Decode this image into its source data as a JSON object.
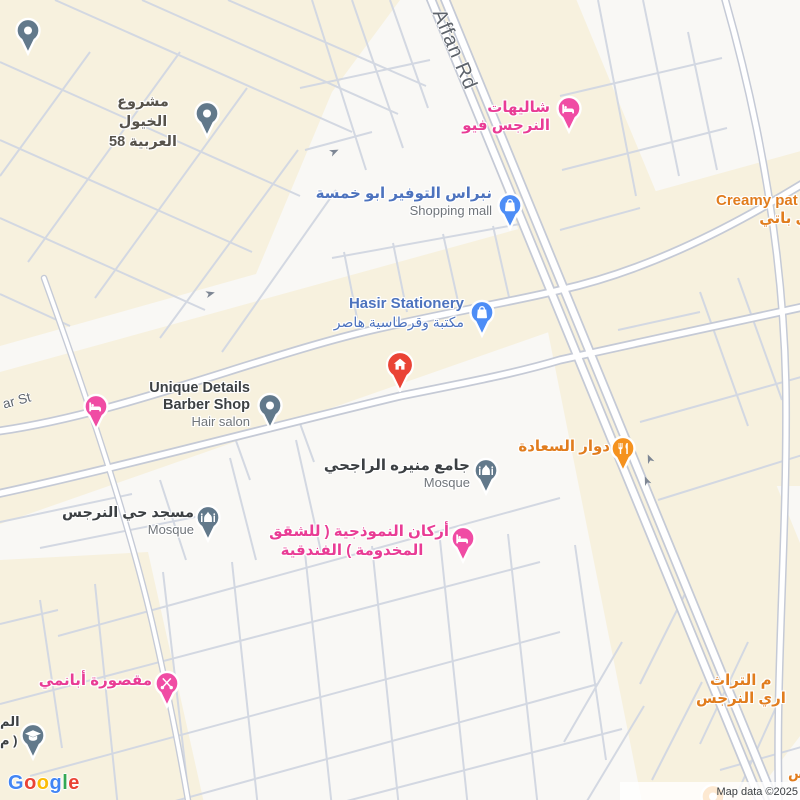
{
  "colors": {
    "shopping_pin": "#4D8DF6",
    "shopping_text": "#4D73BE",
    "hotel_pin": "#F04CA4",
    "hotel_text": "#E93C95",
    "food_pin": "#F5921E",
    "food_text": "#E17D1E",
    "generic_pin": "#62798B",
    "generic_text": "#3C4043",
    "area_text": "#57534C",
    "secondary_text": "#70757A",
    "street_text": "#5E646C",
    "marker_red": "#EA4335",
    "road_casing": "#C5CAD6",
    "road_fill": "#FFFFFF",
    "minor_road": "#D3D8E2",
    "block_cream": "#F7F1DE",
    "block_white": "#F9F8F5"
  },
  "streets": {
    "affan": "Affan Rd",
    "ar_st": "ar St"
  },
  "pois": {
    "horses": {
      "line1": "مشروع الخيول",
      "line2": "العربية 58"
    },
    "chalets": {
      "name": "شاليهات النرجس فيو"
    },
    "nebras": {
      "name": "نبراس التوفير ابو خمسة",
      "sub": "Shopping mall"
    },
    "creamy": {
      "name": "Creamy pat",
      "sub": "مي باتي"
    },
    "hasir": {
      "name": "Hasir Stationery",
      "sub": "مكتبة وقرطاسية هاصر"
    },
    "barber": {
      "line1": "Unique Details",
      "line2": "Barber Shop",
      "sub": "Hair salon"
    },
    "rajhi": {
      "name": "جامع منيره الراجحي",
      "sub": "Mosque"
    },
    "saada": {
      "name": "دوار السعادة"
    },
    "narjis_mosque": {
      "name": "مسجد حي النرجس",
      "sub": "Mosque"
    },
    "arkan": {
      "line1": "أركان النموذجية ( للشقق",
      "line2": "المخدومة ) الفندقية"
    },
    "maqsura": {
      "name": "مقصورة أبانمي"
    },
    "heritage": {
      "line1": "م التراث",
      "line2": "اري النرجس"
    },
    "edge_left": {
      "line1": "الم",
      "line2": "( م"
    },
    "edge_right": {
      "partial": "س"
    }
  },
  "logo_letters": [
    {
      "ch": "G",
      "color": "#4285F4"
    },
    {
      "ch": "o",
      "color": "#EA4335"
    },
    {
      "ch": "o",
      "color": "#FBBC05"
    },
    {
      "ch": "g",
      "color": "#4285F4"
    },
    {
      "ch": "l",
      "color": "#34A853"
    },
    {
      "ch": "e",
      "color": "#EA4335"
    }
  ],
  "attribution": "Map data ©2025"
}
